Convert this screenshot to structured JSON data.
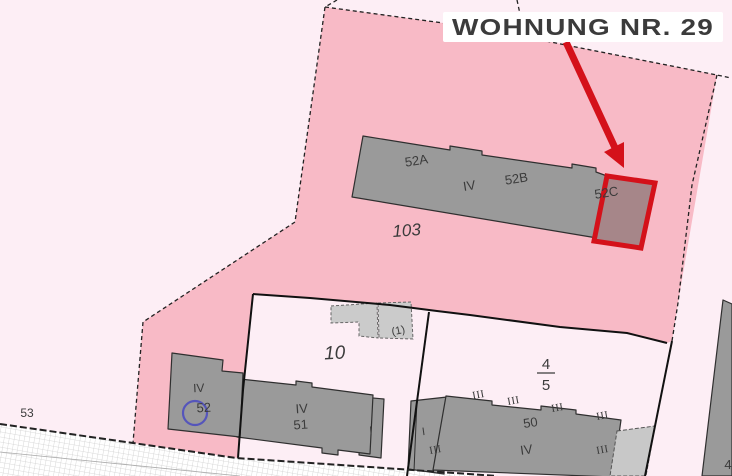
{
  "title": {
    "text": "WOHNUNG NR. 29"
  },
  "parcels": {
    "p103": "103",
    "p10": "10",
    "p53": "53",
    "p45_numerator": "4",
    "p45_denominator": "5"
  },
  "buildings": {
    "row52": {
      "a": "52A",
      "storeys": "IV",
      "b": "52B",
      "c": "52C"
    },
    "h52": {
      "storeys": "IV",
      "no": "52"
    },
    "h51": {
      "storeys": "IV",
      "no": "51",
      "annex": "I"
    },
    "h50": {
      "no": "50",
      "storeys": "IV",
      "annex": "I"
    },
    "h4": {
      "no": "4"
    },
    "shed": {
      "no": "(1)"
    }
  },
  "marks": {
    "iii": [
      "III",
      "III",
      "III",
      "III",
      "III",
      "III"
    ]
  },
  "colors": {
    "highlight_red": "#d4111a",
    "parcel_pink": "#f8bac6",
    "background_pink": "#fdeef5",
    "building_gray": "#9a9a9a",
    "selection_fill": "#a68689",
    "circle_blue": "#5555bb"
  }
}
